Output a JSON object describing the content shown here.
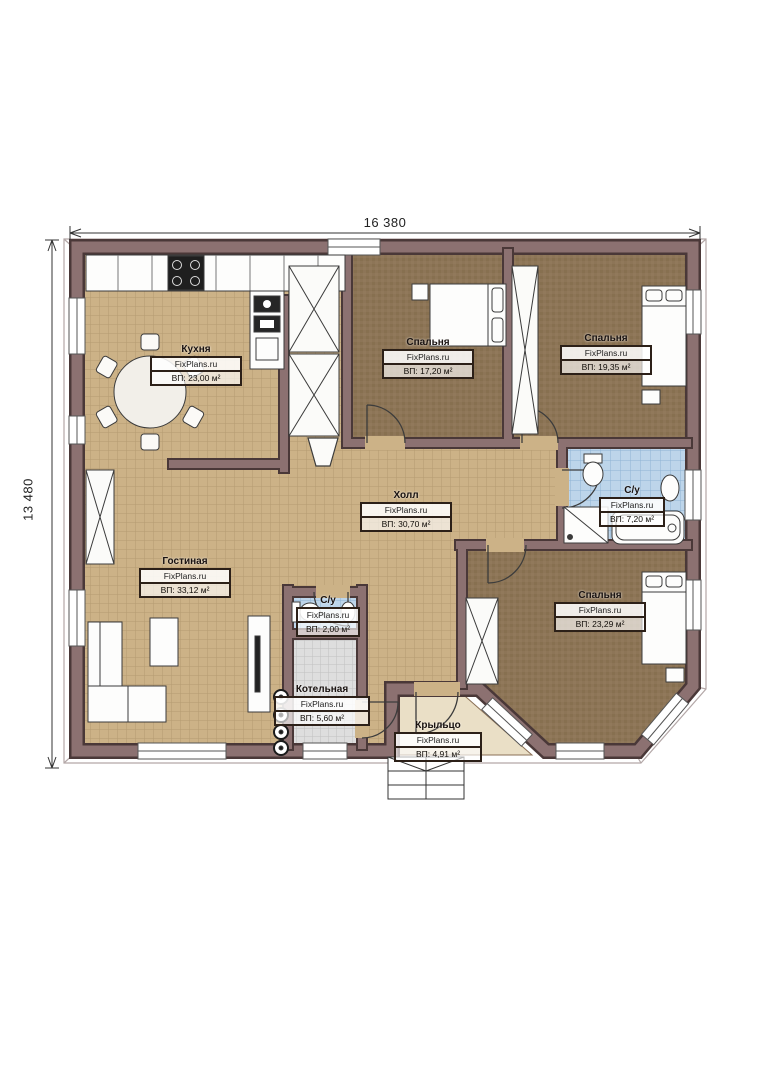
{
  "plan": {
    "dimensions": {
      "width": "16 380",
      "height": "13 480"
    },
    "watermark": "FixPlans.ru",
    "rooms": [
      {
        "id": "kitchen",
        "name": "Кухня",
        "area": "ВП: 23,00 м²"
      },
      {
        "id": "bedroom-1",
        "name": "Спальня",
        "area": "ВП: 17,20 м²"
      },
      {
        "id": "bedroom-2",
        "name": "Спальня",
        "area": "ВП: 19,35 м²"
      },
      {
        "id": "hall",
        "name": "Холл",
        "area": "ВП: 30,70 м²"
      },
      {
        "id": "bathroom",
        "name": "С/у",
        "area": "ВП: 7,20 м²"
      },
      {
        "id": "living-room",
        "name": "Гостиная",
        "area": "ВП: 33,12 м²"
      },
      {
        "id": "wc",
        "name": "С/у",
        "area": "ВП: 2,00 м²"
      },
      {
        "id": "boiler-room",
        "name": "Котельная",
        "area": "ВП: 5,60 м²"
      },
      {
        "id": "bedroom-3",
        "name": "Спальня",
        "area": "ВП: 23,29 м²"
      },
      {
        "id": "porch",
        "name": "Крыльцо",
        "area": "ВП: 4,91 м²"
      }
    ],
    "colors": {
      "wall": "#8c7171",
      "wall_outline": "#4a3838",
      "tile_floor": "#ccb287",
      "bedroom_floor": "#8d7557",
      "bathroom_floor": "#bdd5ea",
      "boiler_floor": "#dedede",
      "porch_floor": "#eadfc6"
    }
  }
}
